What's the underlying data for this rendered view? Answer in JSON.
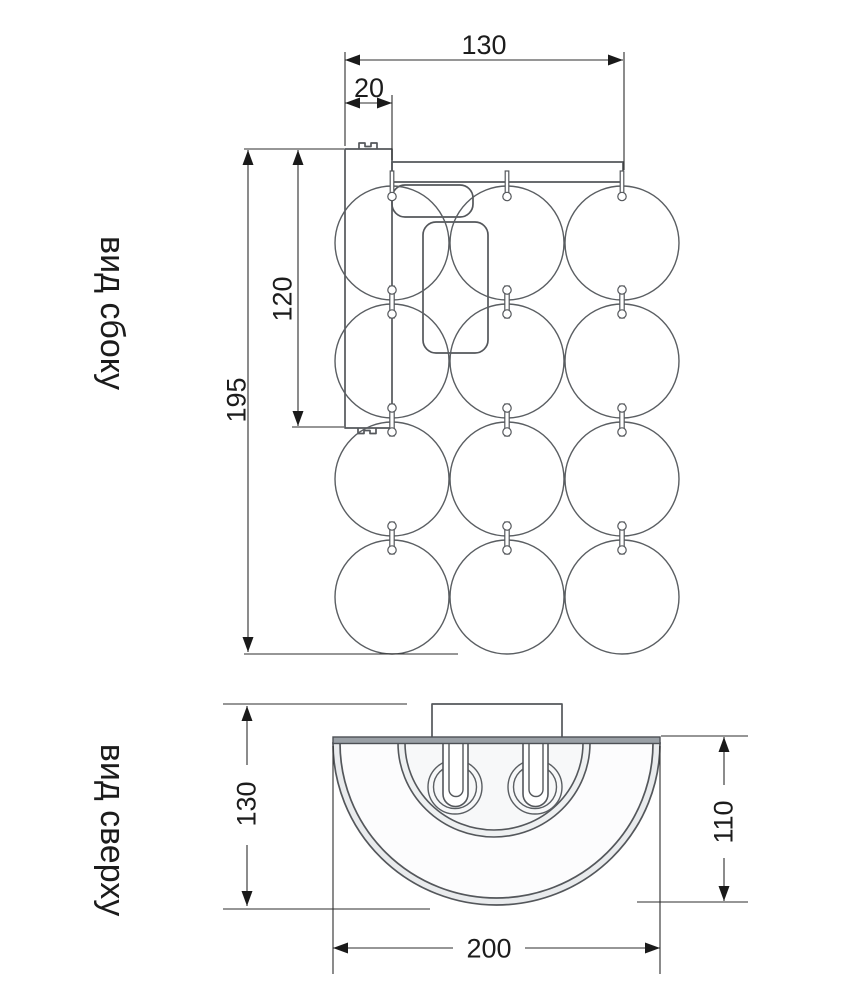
{
  "side_view": {
    "label": "вид сбоку",
    "dims": {
      "total_width": "130",
      "plate_offset": "20",
      "plate_height": "120",
      "total_height": "195"
    }
  },
  "top_view": {
    "label": "вид сверху",
    "dims": {
      "total_depth": "130",
      "shade_depth": "110",
      "shade_width": "200"
    }
  },
  "colors": {
    "background": "#ffffff",
    "drawing_line": "#54575b",
    "dimension_line": "#2d2d2d",
    "text": "#1c1c1c",
    "shade_rim_fill": "#e9ebed",
    "top_bar_fill": "#9aa0a6"
  }
}
